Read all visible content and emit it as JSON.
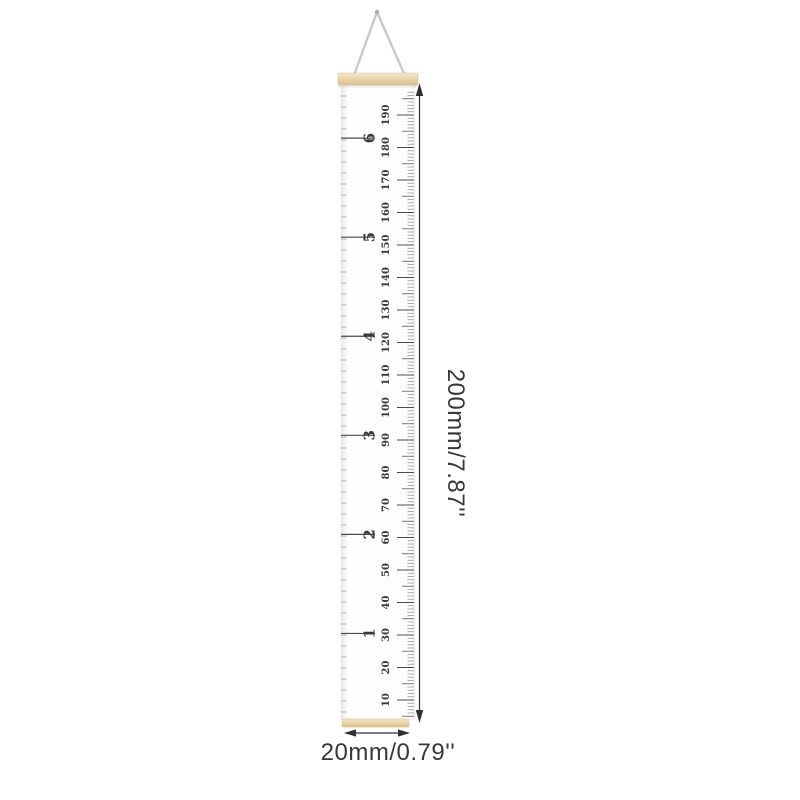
{
  "product": {
    "name": "hanging growth chart ruler",
    "colors": {
      "wood_light": "#f3e6c9",
      "wood": "#e8d3a8",
      "wood_edge": "#d8bf8e",
      "string": "#c9c9c9",
      "canvas": "#fdfdfd",
      "canvas_edge": "#e9e9e9",
      "ink": "#3a3a3a",
      "tick_long": "#4a4a4a",
      "tick_mid": "#6a6a6a",
      "tick_small": "#9a9a9a",
      "tick_left": "#b3b3b3",
      "arrow": "#2f2f2f"
    }
  },
  "scale": {
    "labels": [
      "10",
      "20",
      "30",
      "40",
      "50",
      "60",
      "70",
      "80",
      "90",
      "100",
      "110",
      "120",
      "130",
      "140",
      "150",
      "160",
      "170",
      "180",
      "190"
    ],
    "feet": [
      {
        "label": "1",
        "cm": 30.48
      },
      {
        "label": "2",
        "cm": 60.96
      },
      {
        "label": "3",
        "cm": 91.44
      },
      {
        "label": "4",
        "cm": 121.92
      },
      {
        "label": "5",
        "cm": 152.4
      },
      {
        "label": "6",
        "cm": 182.88
      }
    ]
  },
  "annotations": {
    "height_label": "200mm/7.87''",
    "width_label": "20mm/0.79''"
  }
}
